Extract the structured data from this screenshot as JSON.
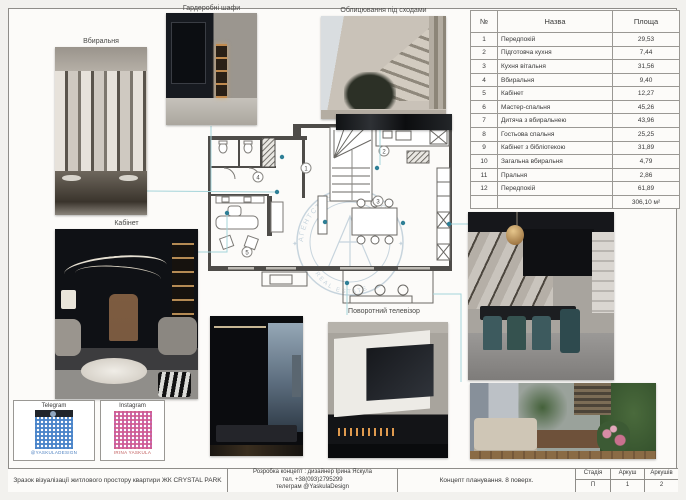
{
  "labels": {
    "dressing_room": "Вбиральня",
    "wardrobes": "Гардеробні шафи",
    "stair_cladding": "Облицювання під сходами",
    "office": "Кабінет",
    "rotating_tv": "Поворотний телевізор"
  },
  "area_table": {
    "headers": {
      "num": "№",
      "name": "Назва",
      "area": "Площа"
    },
    "rows": [
      [
        "1",
        "Передпокій",
        "29,53"
      ],
      [
        "2",
        "Підготовча кухня",
        "7,44"
      ],
      [
        "3",
        "Кухня вітальня",
        "31,56"
      ],
      [
        "4",
        "Вбиральня",
        "9,40"
      ],
      [
        "5",
        "Кабінет",
        "12,27"
      ],
      [
        "6",
        "Мастер-спальня",
        "45,26"
      ],
      [
        "7",
        "Дитяча з вбиральнею",
        "43,96"
      ],
      [
        "8",
        "Гостьова спальня",
        "25,25"
      ],
      [
        "9",
        "Кабінет з бібліотекою",
        "31,89"
      ],
      [
        "10",
        "Загальна вбиральня",
        "4,79"
      ],
      [
        "11",
        "Пральня",
        "2,86"
      ],
      [
        "12",
        "Передпокій",
        "61,89"
      ]
    ],
    "total": "306,10 м²"
  },
  "plan": {
    "room_numbers": [
      "1",
      "2",
      "3",
      "4",
      "5"
    ],
    "watermark_top": "АГЕНТСТВО НЕРУХОМОСТІ",
    "watermark_bottom": "REAL ESTATE"
  },
  "qr": {
    "telegram": {
      "label": "Telegram",
      "caption": "@YASKULADESIGN"
    },
    "instagram": {
      "label": "Instagram",
      "caption": "IRINA YASKULA"
    }
  },
  "title_block": {
    "sample_text": "Зразок візуалізації житлового простору квартири ЖК CRYSTAL PARK",
    "dev_line1": "Розробка концепт : дизайнер Ірина Яскула",
    "dev_line2": "тел. +38(093)2795299",
    "dev_line3": "телеграм @YaskulaDesign",
    "concept_text": "Концепт планування. 8 поверх.",
    "stage_label": "Стадія",
    "stage_value": "П",
    "sheet_label": "Аркуш",
    "sheet_value": "1",
    "sheets_label": "Аркушів",
    "sheets_value": "2"
  }
}
